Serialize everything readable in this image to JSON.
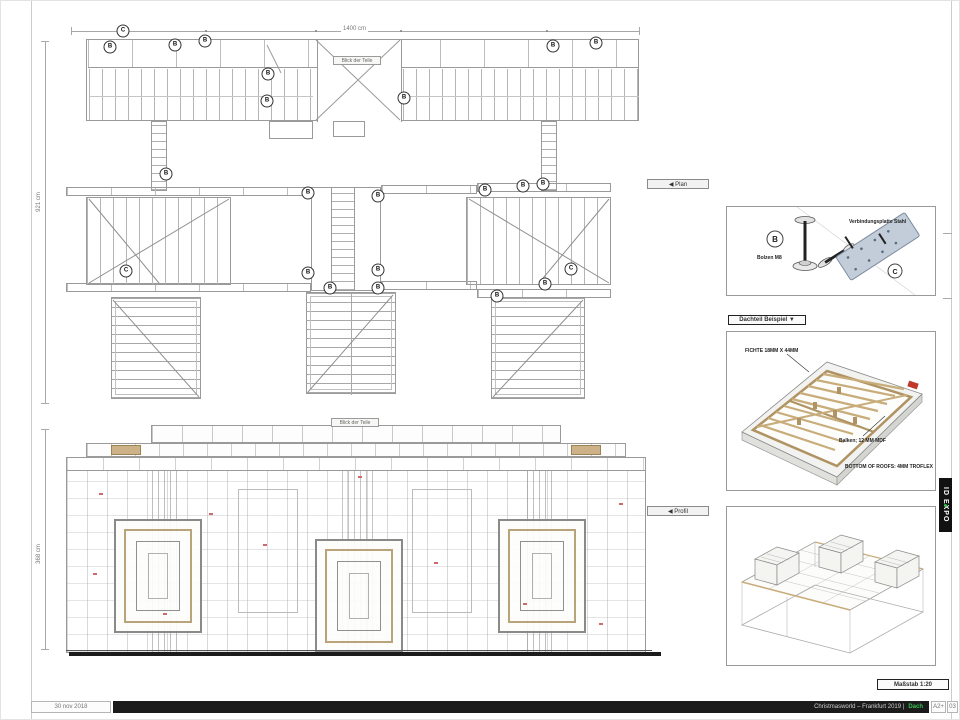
{
  "sheet": {
    "date": "30 nov 2018",
    "scale_label": "Maßstab 1:20",
    "brand": "ID EXPO",
    "footer": {
      "title": "Christmasworld – Frankfurt 2019 |",
      "highlight": "Dach",
      "format": "A2+",
      "page": "03"
    }
  },
  "plan": {
    "label": "◀ Plan",
    "width_dim": "1400 cm",
    "height_dim": "921 cm",
    "tag": "Blick der Teile",
    "markers": [
      {
        "t": "C",
        "x": 122,
        "y": 30
      },
      {
        "t": "B",
        "x": 109,
        "y": 46
      },
      {
        "t": "B",
        "x": 174,
        "y": 44
      },
      {
        "t": "B",
        "x": 204,
        "y": 40
      },
      {
        "t": "B",
        "x": 552,
        "y": 45
      },
      {
        "t": "B",
        "x": 595,
        "y": 42
      },
      {
        "t": "B",
        "x": 267,
        "y": 73
      },
      {
        "t": "B",
        "x": 266,
        "y": 100
      },
      {
        "t": "B",
        "x": 403,
        "y": 97
      },
      {
        "t": "B",
        "x": 165,
        "y": 173
      },
      {
        "t": "B",
        "x": 307,
        "y": 192
      },
      {
        "t": "B",
        "x": 377,
        "y": 195
      },
      {
        "t": "B",
        "x": 484,
        "y": 189
      },
      {
        "t": "B",
        "x": 522,
        "y": 185
      },
      {
        "t": "B",
        "x": 542,
        "y": 183
      },
      {
        "t": "C",
        "x": 125,
        "y": 270
      },
      {
        "t": "B",
        "x": 307,
        "y": 272
      },
      {
        "t": "B",
        "x": 377,
        "y": 269
      },
      {
        "t": "C",
        "x": 570,
        "y": 268
      },
      {
        "t": "B",
        "x": 329,
        "y": 287
      },
      {
        "t": "B",
        "x": 377,
        "y": 287
      },
      {
        "t": "B",
        "x": 496,
        "y": 295
      },
      {
        "t": "B",
        "x": 544,
        "y": 283
      }
    ]
  },
  "profile": {
    "label": "◀ Profil",
    "height_dim": "368 cm",
    "tag": "Blick der Teile"
  },
  "details": {
    "fasteners": {
      "marker_b": "B",
      "bolt_label": "Bolzen M8",
      "plate_label": "Verbindungsplatte Stahl",
      "marker_c": "C"
    },
    "roof": {
      "header": "Dachteil Beispiel ▼",
      "joist_label": "FICHTE 18MM X 44MM",
      "beam_label": "Balken; 12 MM MDF",
      "bottom_label": "BOTTOM OF ROOFS: 4MM TROFLEX"
    }
  },
  "colors": {
    "wood": "#cdb287",
    "steel": "#c2cdd9",
    "accent_red": "#c0392b",
    "accent_green": "#35c24f",
    "line": "#9a9a9a"
  }
}
